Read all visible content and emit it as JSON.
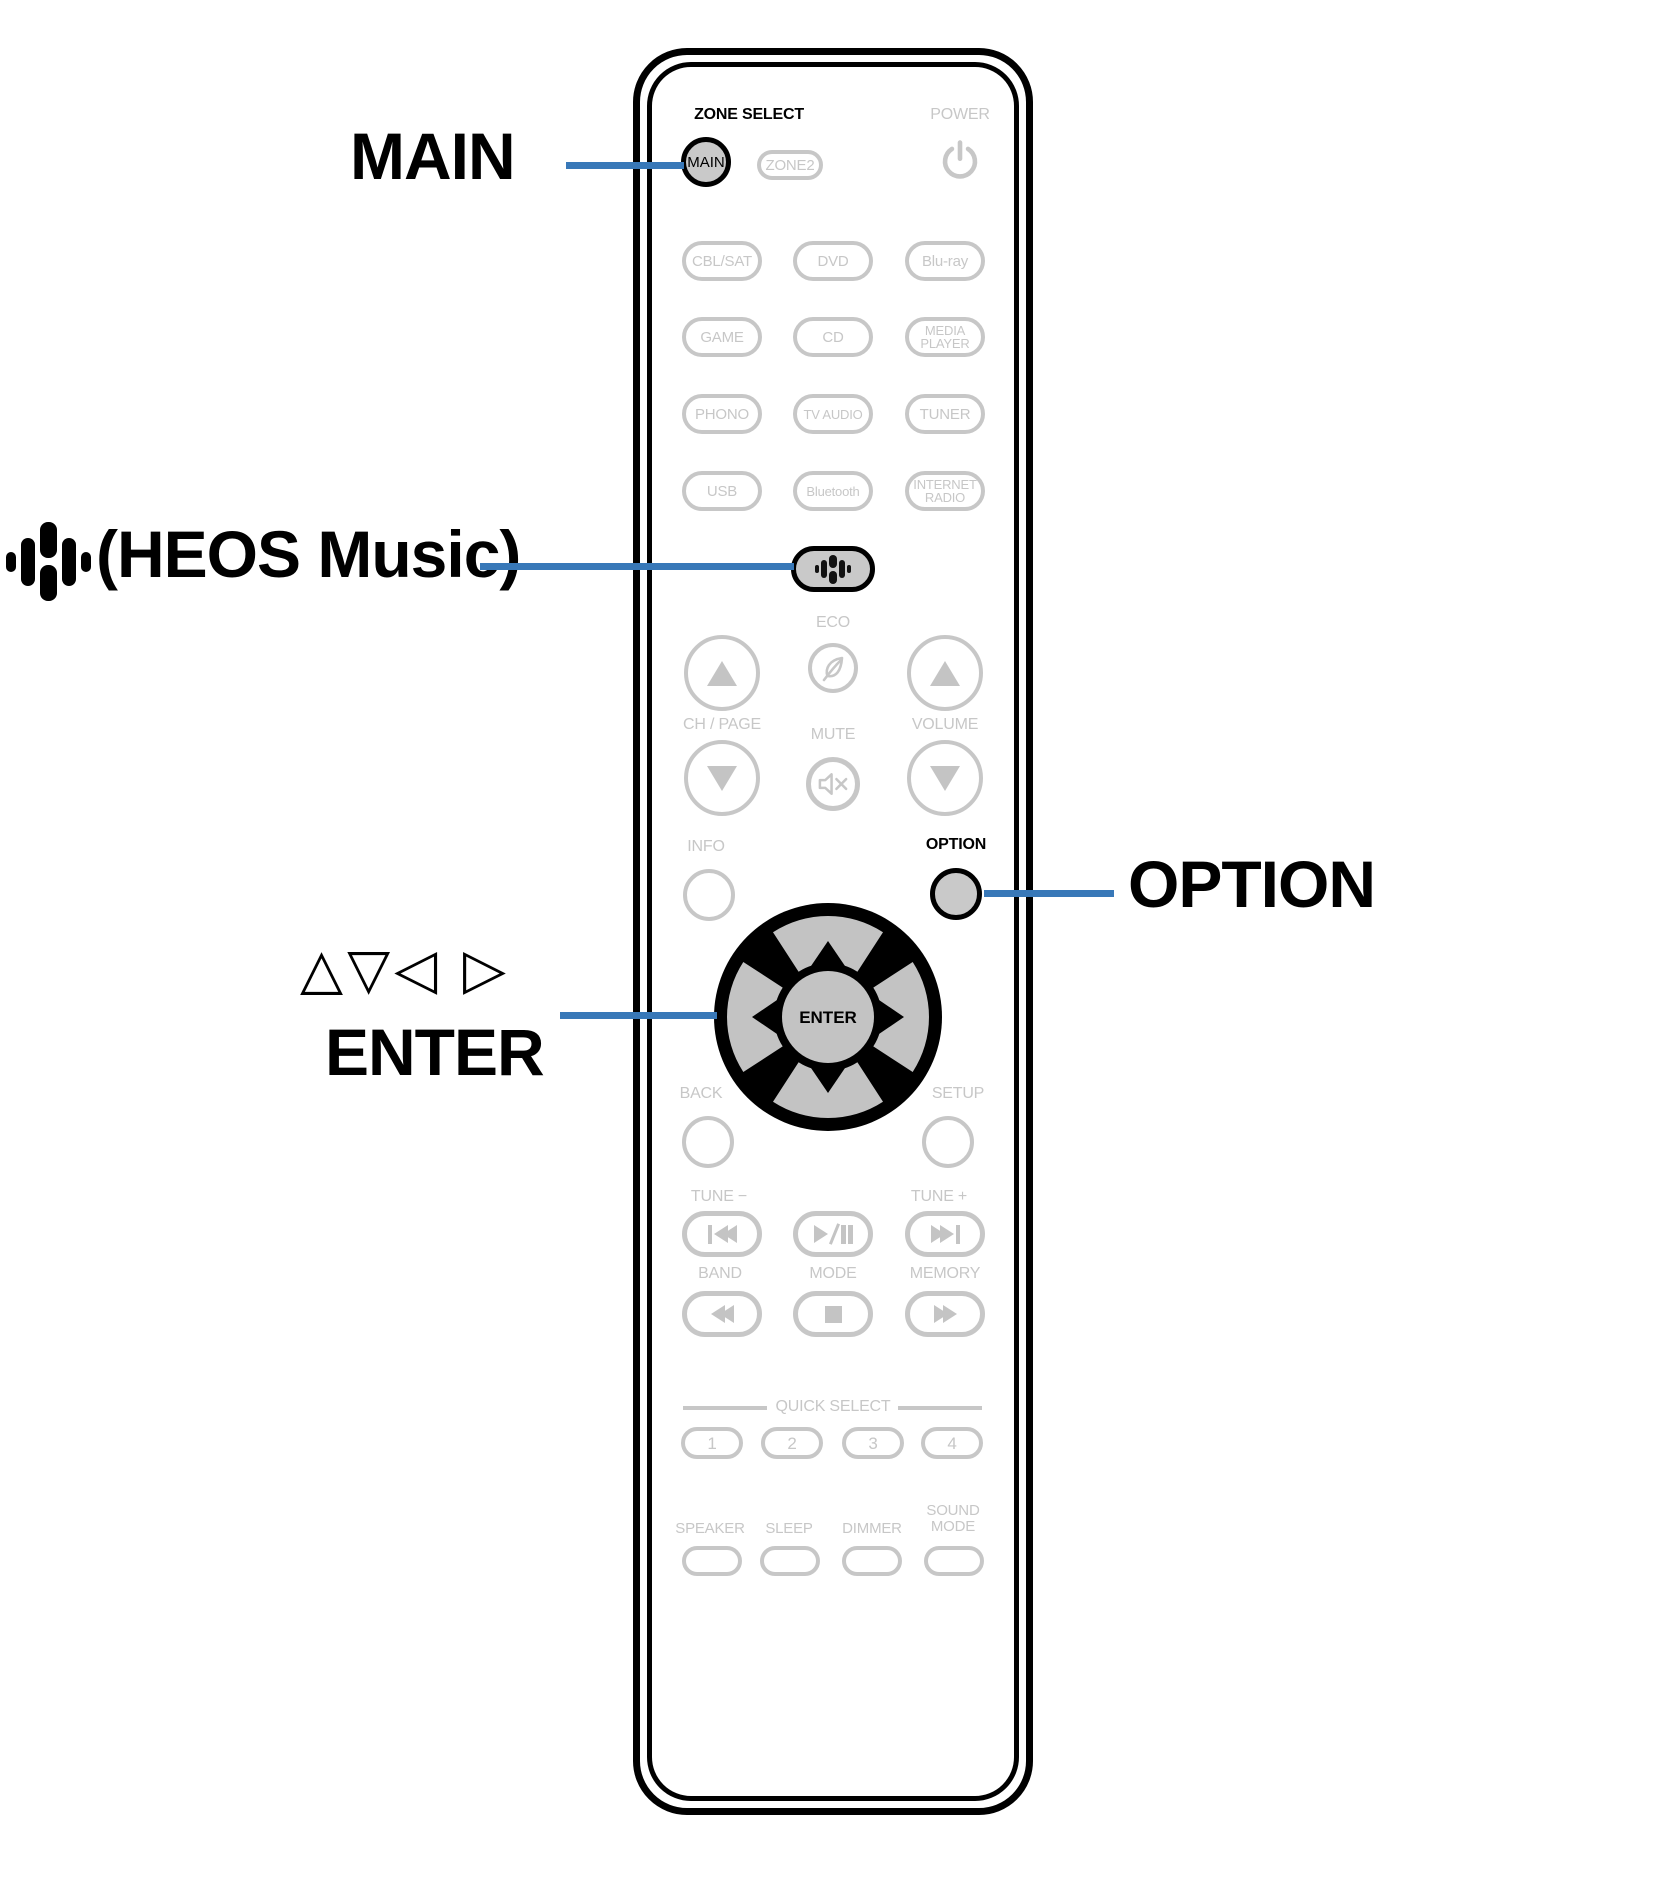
{
  "colors": {
    "accent_blue": "#3878b8",
    "highlight_fill": "#c9c9c9",
    "inactive_gray": "#c7c7c7",
    "dpad_gray": "#c3c3c3",
    "black": "#000000"
  },
  "callouts": {
    "main": "MAIN",
    "heos_label": "(HEOS Music)",
    "cursor_arrows": "△▽◁ ▷",
    "cursor_enter": "ENTER",
    "option": "OPTION"
  },
  "remote": {
    "zone_select_label": "ZONE SELECT",
    "main_button": "MAIN",
    "zone2_button": "ZONE2",
    "power_label": "POWER",
    "source_buttons": [
      "CBL/SAT",
      "DVD",
      "Blu-ray",
      "GAME",
      "CD",
      "MEDIA\nPLAYER",
      "PHONO",
      "TV AUDIO",
      "TUNER",
      "USB",
      "Bluetooth",
      "INTERNET\nRADIO"
    ],
    "eco_label": "ECO",
    "ch_page_label": "CH / PAGE",
    "mute_label": "MUTE",
    "volume_label": "VOLUME",
    "info_label": "INFO",
    "option_label": "OPTION",
    "enter_button": "ENTER",
    "back_label": "BACK",
    "setup_label": "SETUP",
    "tune_minus_label": "TUNE −",
    "tune_plus_label": "TUNE +",
    "band_label": "BAND",
    "mode_label": "MODE",
    "memory_label": "MEMORY",
    "quick_select_label": "QUICK SELECT",
    "quick_buttons": [
      "1",
      "2",
      "3",
      "4"
    ],
    "bottom_labels": [
      "SPEAKER",
      "SLEEP",
      "DIMMER",
      "SOUND\nMODE"
    ]
  },
  "icons": {
    "power": "power-icon",
    "eco": "leaf-icon",
    "mute": "speaker-mute-icon",
    "heos": "heos-wave-icon",
    "prev": "skip-back-icon",
    "play_pause": "play-pause-icon",
    "next": "skip-forward-icon",
    "rewind": "rewind-icon",
    "stop": "stop-icon",
    "ffwd": "fast-forward-icon"
  }
}
